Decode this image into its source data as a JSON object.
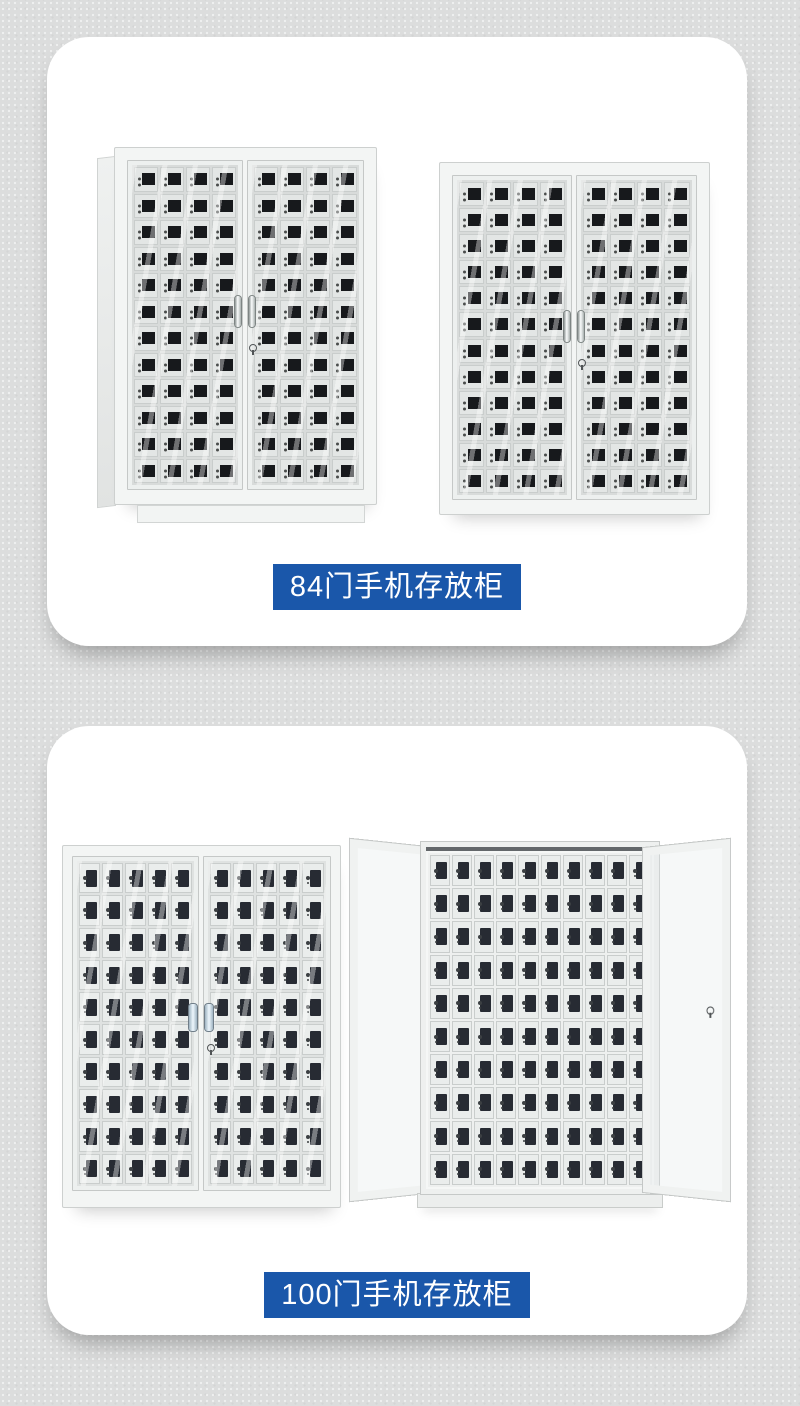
{
  "colors": {
    "page_bg": "#dcdddd",
    "card_bg": "#ffffff",
    "accent_blue": "#1a57aa",
    "caption_text": "#ffffff",
    "locker_window_dark": "#17191c",
    "locker_window_navy": "#272b33"
  },
  "cards": [
    {
      "caption": "84门手机存放柜",
      "figures": [
        {
          "view": "angled-closed",
          "door_grid": {
            "rows": 12,
            "cols": 4,
            "window": "square"
          }
        },
        {
          "view": "front-closed",
          "door_grid": {
            "rows": 12,
            "cols": 4,
            "window": "square"
          }
        }
      ]
    },
    {
      "caption": "100门手机存放柜",
      "figures": [
        {
          "view": "front-closed",
          "door_grid": {
            "rows": 10,
            "cols": 5,
            "window": "tall"
          }
        },
        {
          "view": "doors-open",
          "interior_grid": {
            "rows": 10,
            "cols": 10,
            "window": "tall"
          }
        }
      ]
    }
  ]
}
